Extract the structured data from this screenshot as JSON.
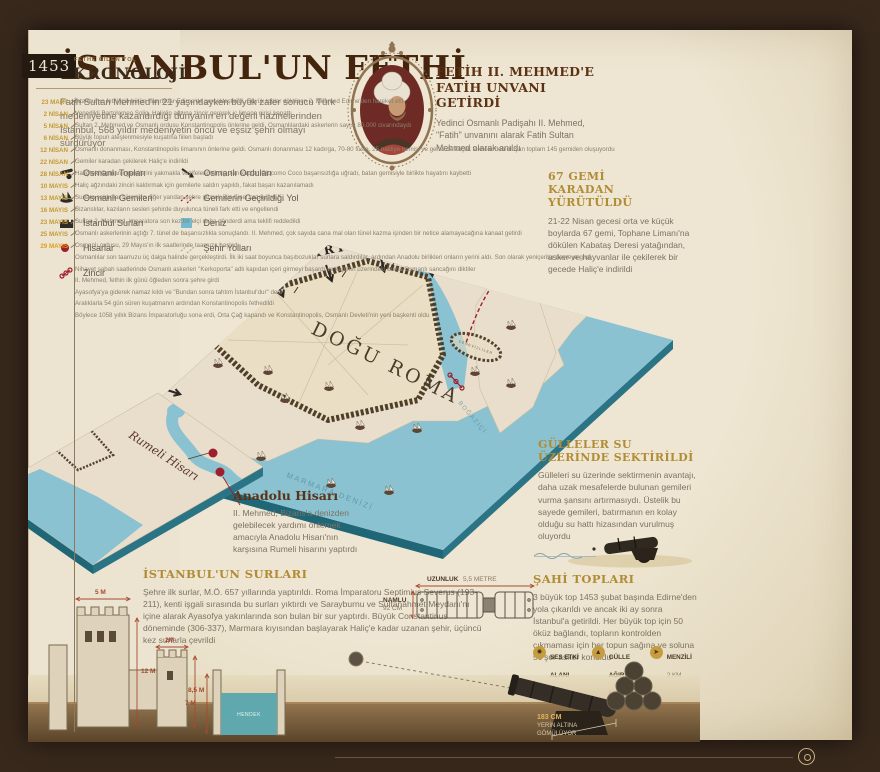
{
  "poster": {
    "title": "İSTANBUL'UN FETHİ",
    "intro": "Fatih Sultan Mehmed'in 21 yaşındayken büyük zafer sonucu Türk medeniyetine kazandırdığı dünyanın en değerli hazinelerinden İstanbul, 568 yıldır medeniyetin öncü ve eşsiz şehri olmayı sürdürüyor"
  },
  "portrait_section": {
    "heading_line1": "FETİH II. MEHMED'E",
    "heading_line2": "FATİH UNVANI GETİRDİ",
    "body": "Yedinci Osmanlı Padişahı II. Mehmed, \"Fatih\" unvanını alarak Fatih Sultan Mehmed olarak anıldı"
  },
  "legend": {
    "col1": [
      {
        "icon": "cannon-icon",
        "label": "Osmanlı Topları"
      },
      {
        "icon": "ship-icon",
        "label": "Osmanlı Gemileri"
      },
      {
        "icon": "wall-icon",
        "label": "İstanbul Surları"
      },
      {
        "icon": "fortress-dot-icon",
        "label": "Hisarlar"
      },
      {
        "icon": "chain-icon",
        "label": "Zincir"
      }
    ],
    "col2": [
      {
        "icon": "army-arrow-icon",
        "label": "Osmanlı Orduları"
      },
      {
        "icon": "portage-route-icon",
        "label": "Gemilerin Geçirildiği Yol"
      },
      {
        "icon": "sea-swatch-icon",
        "label": "Deniz"
      },
      {
        "icon": "city-roads-icon",
        "label": "Şehir Yolları"
      }
    ]
  },
  "map": {
    "armies_label": "OSMANLI ORDULARI",
    "city_label": "DOĞU ROMA",
    "galata_label": "CENEVİZLİLER",
    "marmara_label": "MARMARA DENİZİ",
    "bosphorus_label": "BOĞAZİÇİ",
    "rumeli_label": "Rumeli Hisarı",
    "sea_color": "#8ac2d2",
    "land_color": "#e8decb",
    "wall_color": "#4f3f28",
    "accent_red": "#9e1f2b"
  },
  "sec_gemi67": {
    "heading_line1": "67 GEMİ",
    "heading_line2": "KARADAN YÜRÜTÜLDÜ",
    "body": "21-22 Nisan gecesi orta ve küçük boylarda 67 gemi, Tophane Limanı'na dökülen Kabataş Deresi yatağından, asker ve hayvanlar ile çekilerek bir gecede Haliç'e indirildi"
  },
  "sec_gulleler": {
    "heading_line1": "GÜLLELER SU",
    "heading_line2": "ÜZERİNDE SEKTİRİLDİ",
    "body": "Gülleleri su üzerinde sektirmenin avantajı, daha uzak mesafelerde bulunan gemileri vurma şansını artırmasıydı. Üstelik bu sayede gemileri, batırmanın en kolay olduğu su hattı hizasından vurulmuş oluyordu"
  },
  "sec_anadolu": {
    "heading": "Anadolu Hisarı",
    "body": "II. Mehmed, Bizans'a denizden gelebilecek yardımı önlemek amacıyla Anadolu Hisarı'nın karşısına Rumeli hisarını yaptırdı"
  },
  "sec_surlar": {
    "heading": "İSTANBUL'UN SURLARI",
    "body": "Şehre ilk surlar, M.Ö. 657 yıllarında yaptırıldı. Roma İmparatoru Septimius Severus (193-211), kenti işgali sırasında bu surları yıktırdı ve Sarayburnu ve Sultanahmet Meydanı'nı içine alarak Ayasofya yakınlarında son bulan bir sur yaptırdı. Büyük Constantinus döneminde (306-337), Marmara kıyısından başlayarak Haliç'e kadar uzanan şehir, üçüncü kez surlarla çevrildi"
  },
  "sec_sahi": {
    "heading": "ŞAHİ TOPLARI",
    "body": "3 büyük top 1453 şubat başında Edirne'den yola çıkarıldı ve ancak iki ay sonra İstanbul'a getirildi. Her büyük top için 50 öküz bağlandı, topların kontrolden çıkmaması için her topun sağına ve soluna 50'şer asker konuldu",
    "stats": [
      {
        "icon": "sound-burst-icon",
        "label1": "SES ETKİ",
        "label2": "ALANI",
        "value": "24 KM"
      },
      {
        "icon": "weight-icon",
        "label1": "GÜLLE",
        "label2": "AĞIRLIĞI",
        "value": "600 KG"
      },
      {
        "icon": "range-icon",
        "label1": "MENZİLİ",
        "label2": "",
        "value": "2 KM"
      }
    ]
  },
  "cannon_diagram": {
    "length_label": "UZUNLUK",
    "length_value": "5,5 METRE",
    "barrel_label": "NAMLU",
    "barrel_value": "92 CM",
    "buried_value": "183 CM",
    "buried_line1": "YERİN ALTINA",
    "buried_line2": "GÖMÜLÜYOR"
  },
  "wall_diagram": {
    "tower1_width": "5 M",
    "tower1_height": "12 M",
    "tower2_width": "2M",
    "tower2_height": "8,5 M",
    "moat_depth": "7 M",
    "moat_label": "HENDEK"
  },
  "kronoloji": {
    "year": "1453",
    "kicker": "FETHE GİDEN YOL",
    "title": "KRONOLOJİ",
    "entries": [
      {
        "date": "23 MART",
        "text": "İstanbul'un fethi için bütün hazırlıklar Edirne'de gerçekleştirildi. Büyük toplar döktüren 2. Mehmed Edirne'den hareket etti"
      },
      {
        "date": "2 NİSAN",
        "text": "Venedikli Bartolomeo Solig, Haliç'in ağzına zincir gererek iç limana girişi kapattı"
      },
      {
        "date": "5 NİSAN",
        "text": "Sultan 2. Mehmed ve Osmanlı ordusu Konstantinopolis önlerine geldi. Osmanlılardaki askerlerin sayısı 80.000 civarındaydı"
      },
      {
        "date": "6 NİSAN",
        "text": "Büyük topun ateşlenmesiyle kuşatma fiilen başladı"
      },
      {
        "date": "12 NİSAN",
        "text": "Osmanlı donanması, Konstantinopolis limanının önlerine geldi. Osmanlı donanması 12 kadırga, 70-80 fusta, 25 nakliye gemisi ve gerisi de küçük teknelerden oluşan toplam 145 gemiden oluşuyordu"
      },
      {
        "date": "22 NİSAN",
        "text": "Gemiler karadan çekilerek Haliç'e indirildi"
      },
      {
        "date": "28 NİSAN",
        "text": "Haliç'teki Osmanlı gemilerini yakmakla vazifelendirilmiş olan kaptan Giocomo Coco başarısızlığa uğradı, batan gemisiyle birlikte hayatını kaybetti"
      },
      {
        "date": "10 MAYIS",
        "text": "Haliç ağzındaki zinciri kaldırmak için gemilerle saldırı yapıldı, fakat başarı kazanılamadı"
      },
      {
        "date": "13 MAYIS",
        "text": "Surlara saldırılar sürerken diğer yandan şehre girmek için tünel kazılıyordu"
      },
      {
        "date": "16 MAYIS",
        "text": "Bizanslılar, kazıların sesleri şehirde duyulunca tüneli fark etti ve engellendi"
      },
      {
        "date": "23 MAYIS",
        "text": "Sultan 2. Mehmed, imparatora son kez bir elçi daha gönderdi ama teklifi reddedildi"
      },
      {
        "date": "25 MAYIS",
        "text": "Osmanlı askerlerinin açtığı 7. tünel de başarısızlıkla sonuçlandı. II. Mehmed, çok sayıda cana mal olan tünel kazma işinden bir netice alamayacağına kanaat getirdi"
      },
      {
        "date": "29 MAYIS",
        "text": "Osmanlı ordusu, 29 Mayıs'ın ilk saatlerinde taarruza başladı"
      },
      {
        "date": "",
        "text": "Osmanlılar son taarruzu üç dalga halinde gerçekleştirdi. İlk iki saat boyunca başıbozuklar surlara saldırdılar, ardından Anadolu birlikleri onların yerini aldı. Son olarak yeniçeriler devreye girdi"
      },
      {
        "date": "",
        "text": "Nihayet sabah saatlerinde Osmanlı askerleri \"Kerkoporta\" adlı kapıdan içeri girmeyi başardı ve kapının üzerindeki burca Osmanlı sancağını diktiler"
      },
      {
        "date": "",
        "text": "II. Mehmed, fethin ilk günü öğleden sonra şehre girdi"
      },
      {
        "date": "",
        "text": "Ayasofya'ya giderek namaz kıldı ve \"Bundan sonra tahtım İstanbul'dur\" dedi"
      },
      {
        "date": "",
        "text": "Aralıklarla 54 gün süren kuşatmanın ardından Konstantinopolis fethedildi"
      },
      {
        "date": "",
        "text": "Böylece 1058 yıllık Bizans İmparatorluğu sona erdi, Orta Çağ kapandı ve Konstantinopolis, Osmanlı Devleti'nin yeni başkenti oldu"
      }
    ]
  }
}
